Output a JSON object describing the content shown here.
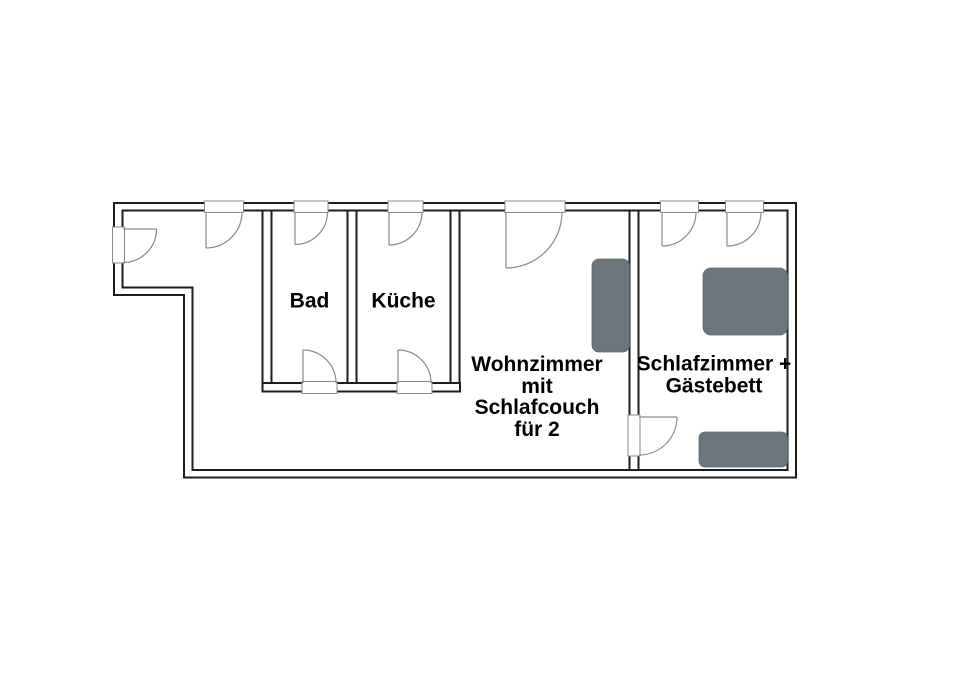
{
  "floorplan": {
    "type": "apartment-floor-plan",
    "rooms": [
      {
        "id": "bad",
        "label": "Bad"
      },
      {
        "id": "kueche",
        "label": "Küche"
      },
      {
        "id": "wohnzimmer",
        "label_lines": [
          "Wohnzimmer",
          "mit",
          "Schlafcouch",
          "für 2"
        ]
      },
      {
        "id": "schlafzimmer",
        "label_lines": [
          "Schlafzimmer +",
          "Gästebett"
        ]
      }
    ],
    "furniture": [
      {
        "id": "schlafcouch",
        "room": "wohnzimmer"
      },
      {
        "id": "bett",
        "room": "schlafzimmer"
      },
      {
        "id": "gaestebett",
        "room": "schlafzimmer"
      }
    ],
    "colors": {
      "wall": "#1d1d1d",
      "door": "#8a8a8a",
      "furniture": "#6a757c",
      "text": "#000000",
      "background": "#ffffff"
    }
  }
}
